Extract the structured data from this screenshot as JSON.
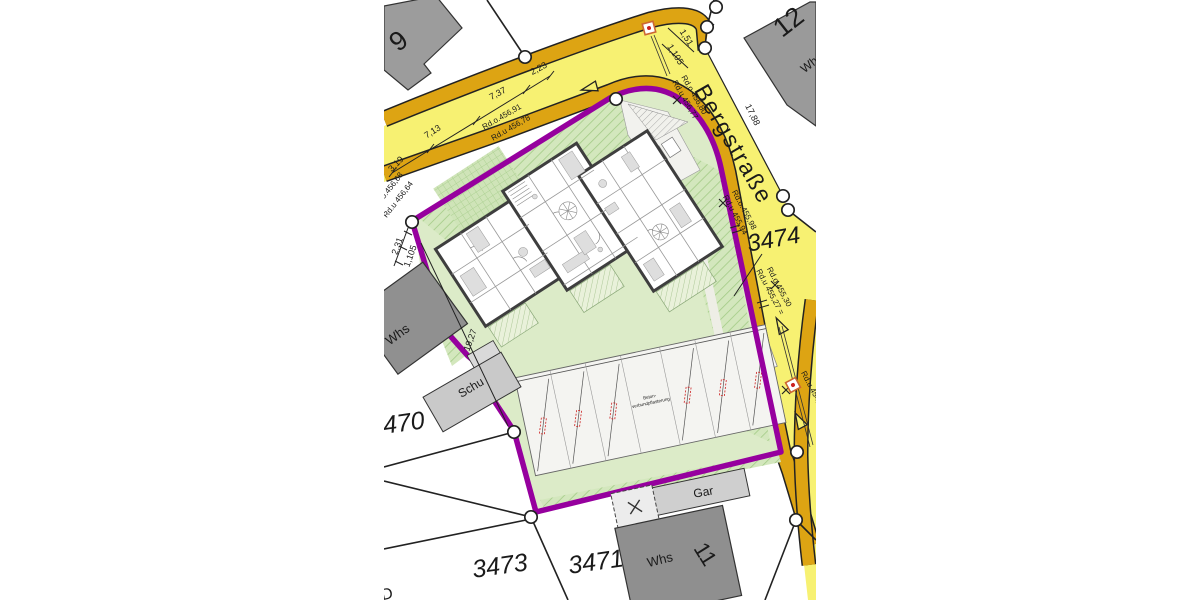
{
  "street": {
    "name": "Bergstraße"
  },
  "parcels": {
    "site": "3474",
    "west": "3470",
    "southwest": "3473",
    "south": "3471"
  },
  "buildings": {
    "house_9": "9",
    "house_12": "12",
    "house_12_type": "Whs",
    "west_house": "Whs",
    "shed": "Schu",
    "garage": "Gar",
    "south_house": "Whs",
    "south_house_number": "11",
    "partial_letter": "D"
  },
  "dimensions": {
    "d1": "2,23",
    "d2": "7,37",
    "d3": "7,13",
    "d4": "3,19",
    "d5": "2,31",
    "d6": "1,105",
    "d7": "19,27",
    "d8": "1,51",
    "d9": "1,105",
    "d10": "17,88"
  },
  "curb_levels": {
    "nw_top": "Rd.o.456,91",
    "nw_bottom": "Rd.u 456,78",
    "w_top": "Rd.o.456,68",
    "w_bottom": "Rd.u 456,64",
    "ne_top": "Rd.o 456,80",
    "ne_bottom": "Rd.u 456,77",
    "e_top": "Rd.o.455,98",
    "e_bottom": "Rd.u 455,94",
    "se_top": "Rd.o.455,30",
    "se_bottom": "Rd.u 455,27 =",
    "s_bottom": "Rd.u 454,9"
  },
  "parking": {
    "note_line1": "Beton-",
    "note_line2": "verbundpflasterung"
  },
  "colors": {
    "street_yellow": "#f7f172",
    "street_band": "#dda413",
    "boundary_purple": "#96009e",
    "site_green": "#dcebc8",
    "building_grey": "#969696"
  }
}
